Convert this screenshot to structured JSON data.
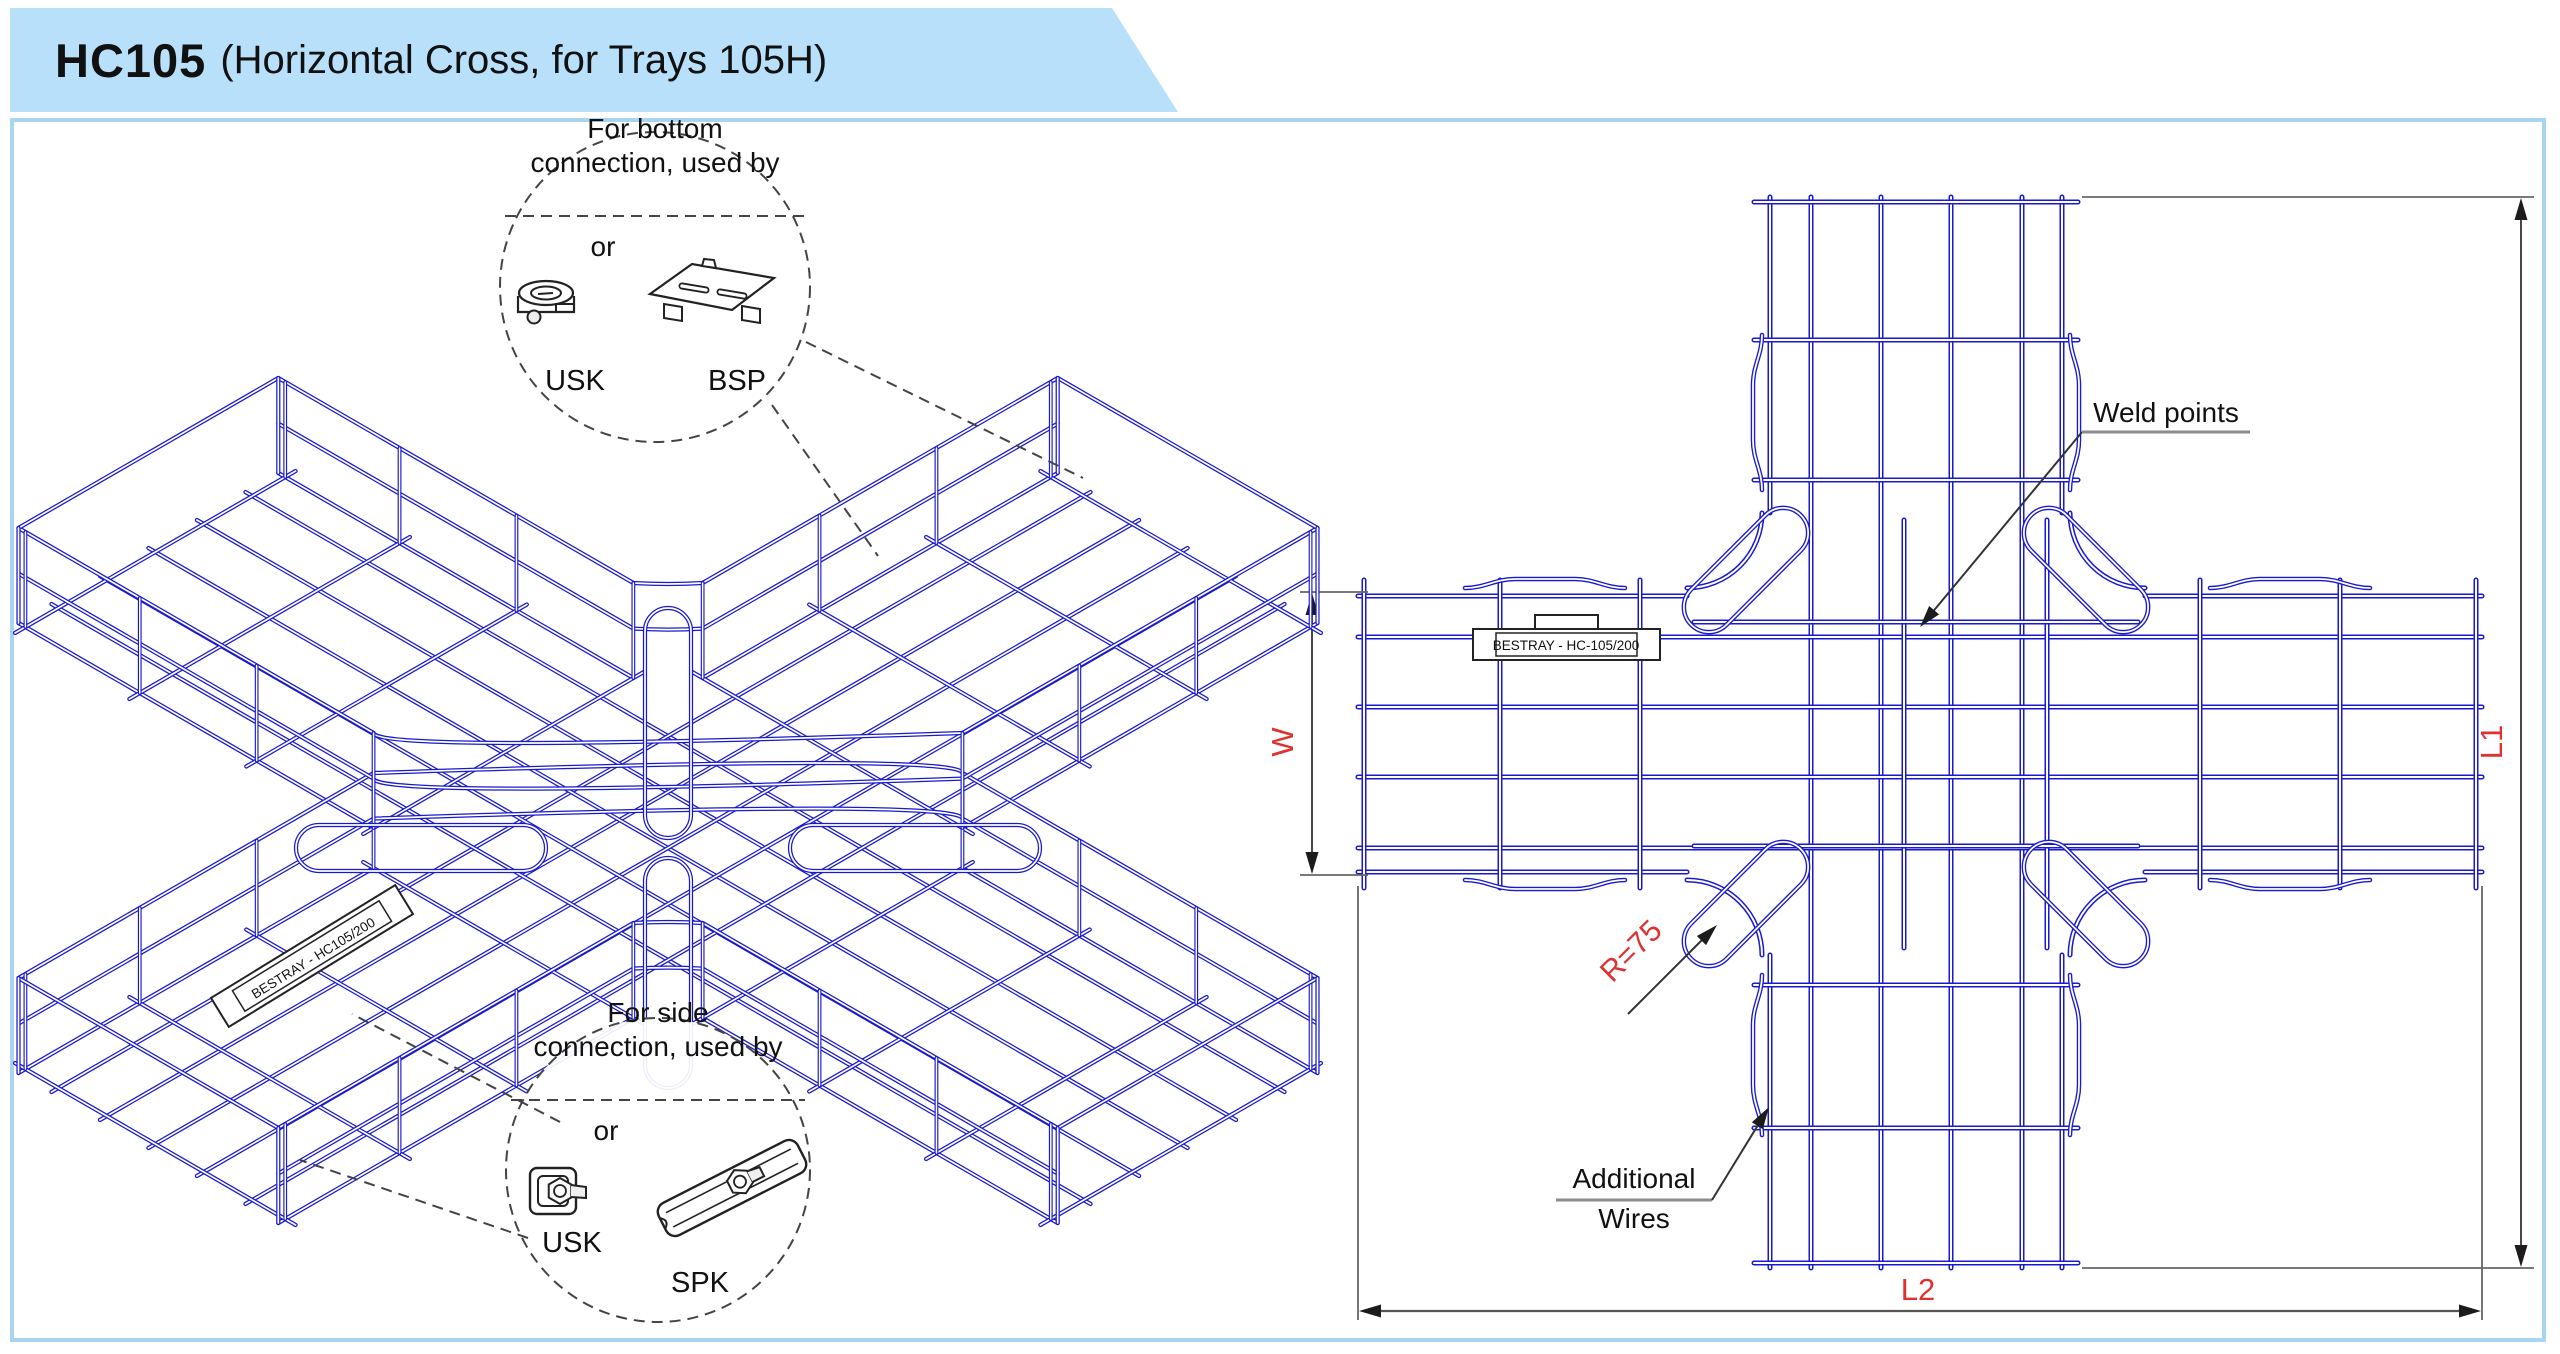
{
  "header": {
    "product_code": "HC105",
    "subtitle": "(Horizontal Cross, for Trays 105H)"
  },
  "colors": {
    "header_bg": "#b9e0fa",
    "panel_border": "#a8d5f0",
    "wire_blue": "#1a1acd",
    "dim_red": "#e03030",
    "line_black": "#1c1c1c",
    "dim_gray": "#666666",
    "leader_gray": "#8a8a8a"
  },
  "iso_view": {
    "label_tag": "BESTRAY - HC105/200",
    "callout_top": {
      "line1": "For bottom",
      "line2": "connection, used by",
      "or_label": "or",
      "item1_label": "USK",
      "item2_label": "BSP",
      "center": [
        655,
        287
      ],
      "radius": 155
    },
    "callout_side": {
      "line1": "For side",
      "line2": "connection, used by",
      "or_label": "or",
      "item1_label": "USK",
      "item2_label": "SPK",
      "center": [
        658,
        1170
      ],
      "radius": 152
    },
    "geometry": {
      "center": [
        668,
        848
      ],
      "half_length": 600,
      "half_width": 150,
      "rail_height": 95,
      "edge_t0": 190,
      "floor_offsets": [
        -112,
        -56,
        0,
        56,
        112
      ],
      "cross_ts": [
        190,
        325,
        460,
        592
      ],
      "gussets": [
        {
          "cx": 668,
          "cy": 973,
          "len": 230,
          "wid": 46,
          "vert": true
        },
        {
          "cx": 668,
          "cy": 723,
          "len": 230,
          "wid": 46,
          "vert": true
        },
        {
          "cx": 915,
          "cy": 848,
          "len": 250,
          "wid": 46,
          "vert": false
        },
        {
          "cx": 421,
          "cy": 848,
          "len": 250,
          "wid": 46,
          "vert": false
        }
      ],
      "tag_pos": [
        312,
        956
      ],
      "tag_angle": -31.5
    }
  },
  "plan_view": {
    "label_tag": "BESTRAY - HC-105/200",
    "weld_points_label": "Weld points",
    "additional_wires_line1": "Additional",
    "additional_wires_line2": "Wires",
    "dim_w_label": "W",
    "dim_l1_label": "L1",
    "dim_l2_label": "L2",
    "radius_label": "R=75",
    "geometry": {
      "vx": [
        1762,
        2070
      ],
      "vy": [
        197,
        1268
      ],
      "hx": [
        1358,
        2482
      ],
      "hy": [
        588,
        880
      ],
      "fillet_r": 75,
      "v_long": [
        1770,
        1811,
        1881,
        1951,
        2022,
        2062
      ],
      "h_long": [
        596,
        637,
        707,
        777,
        848,
        872
      ],
      "v_cross": [
        202,
        340,
        480,
        985,
        1128,
        1263
      ],
      "h_cross": [
        1364,
        1500,
        1640,
        2200,
        2340,
        2476
      ],
      "j_cross_x": [
        1904,
        2047
      ],
      "j_cross_y": [
        622,
        846
      ],
      "gussets": [
        {
          "cx": 1746,
          "cy": 570,
          "rot": -45
        },
        {
          "cx": 2086,
          "cy": 570,
          "rot": 45
        },
        {
          "cx": 1746,
          "cy": 904,
          "rot": -45
        },
        {
          "cx": 2086,
          "cy": 904,
          "rot": 45
        }
      ],
      "gusset_len": 155,
      "gusset_wid": 50,
      "jogs": [
        {
          "x": 1762,
          "y1": 355,
          "y2": 470,
          "dx": -9,
          "vert": true
        },
        {
          "x": 2070,
          "y1": 355,
          "y2": 470,
          "dx": 9,
          "vert": true
        },
        {
          "x": 1762,
          "y1": 995,
          "y2": 1115,
          "dx": -9,
          "vert": true
        },
        {
          "x": 2070,
          "y1": 995,
          "y2": 1115,
          "dx": 9,
          "vert": true
        },
        {
          "x": 1485,
          "y1": 588,
          "y2": 588,
          "x2": 1605,
          "dy": -9,
          "vert": false
        },
        {
          "x": 1485,
          "y1": 880,
          "y2": 880,
          "x2": 1605,
          "dy": 9,
          "vert": false
        },
        {
          "x": 2230,
          "y1": 588,
          "y2": 588,
          "x2": 2350,
          "dy": -9,
          "vert": false
        },
        {
          "x": 2230,
          "y1": 880,
          "y2": 880,
          "x2": 2350,
          "dy": 9,
          "vert": false
        }
      ]
    }
  }
}
